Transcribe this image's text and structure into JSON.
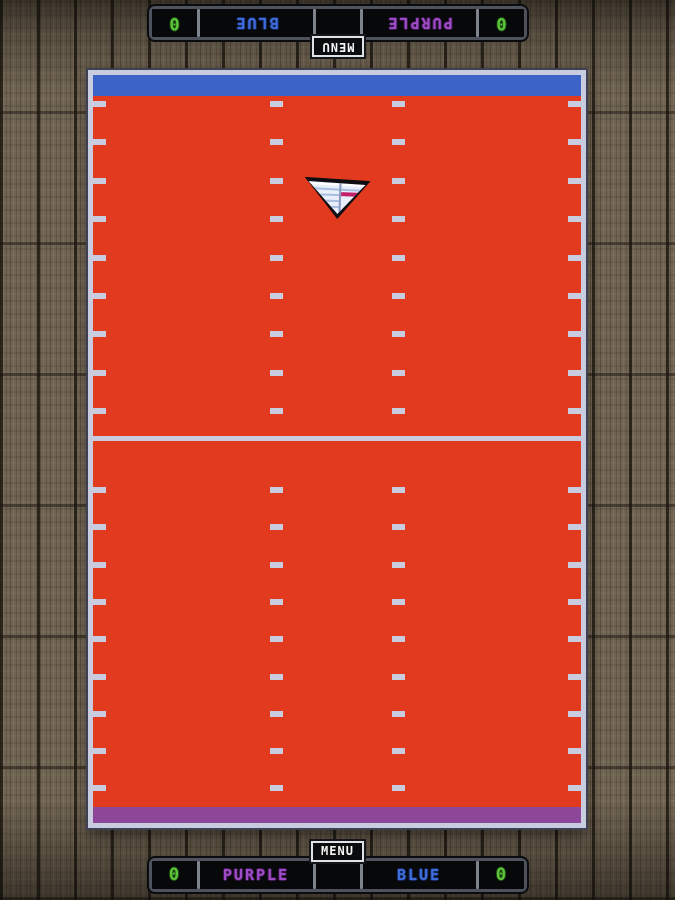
{
  "theme": {
    "wood_base": "#6f6351",
    "field_red": "#e23a1e",
    "goal_blue": "#3c64c8",
    "goal_purple": "#8c4798",
    "line_gray": "#c9cbde",
    "score_green": "#5bc43b",
    "name_purple": "#a04cc8",
    "name_blue": "#3f6edc"
  },
  "hud": {
    "menu_label": "MENU",
    "scoreboard": {
      "left_score": "0",
      "left_team": "PURPLE",
      "middle": "",
      "right_team": "BLUE",
      "right_score": "0"
    }
  },
  "game": {
    "sprite": "paper-plane-facing-down"
  }
}
